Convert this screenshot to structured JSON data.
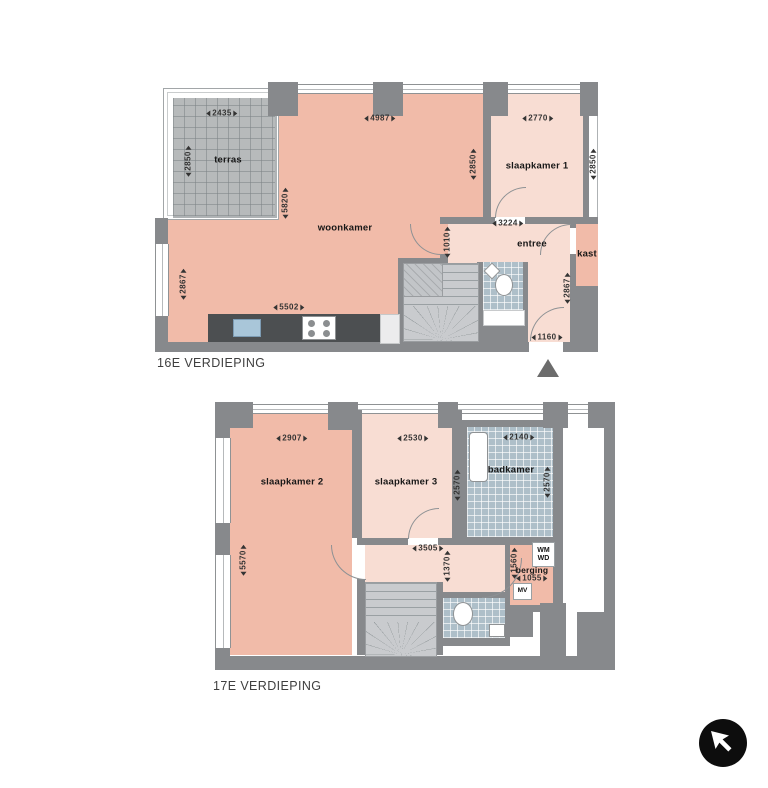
{
  "colors": {
    "room_salmon": "#f1bba9",
    "room_pink": "#f8ddd3",
    "wall_gray": "#87898c",
    "terrace_tile": "#b7babb",
    "bath_tile": "#aebfc9",
    "stair_gray": "#c9cbce",
    "counter_dark": "#4c4f51",
    "sink_blue": "#a9c6d9",
    "entrance_marker_gray": "#6c6c6c",
    "logo_black": "#0d0d0d"
  },
  "floors": [
    {
      "label": "16E VERDIEPING",
      "rooms": {
        "terras": "terras",
        "woonkamer": "woonkamer",
        "slaapkamer1": "slaapkamer 1",
        "entree": "entree",
        "kast": "kast"
      },
      "dims": {
        "terras_w": "2435",
        "terras_h": "2850",
        "woonkamer_w": "4987",
        "woonkamer_glass_h": "5820",
        "woonkamer_left_h": "2867",
        "kitchen_w": "5502",
        "slaapkamer1_w": "2770",
        "slaapkamer1_left_h": "2850",
        "slaapkamer1_right_h": "2850",
        "entree_w": "3224",
        "entree_left_h": "1010",
        "entree_right_h": "2867",
        "entry_w": "1160"
      }
    },
    {
      "label": "17E VERDIEPING",
      "rooms": {
        "slaapkamer2": "slaapkamer 2",
        "slaapkamer3": "slaapkamer 3",
        "badkamer": "badkamer",
        "berging": "berging"
      },
      "appliances": {
        "wm": "WM",
        "wd": "WD",
        "mv": "MV"
      },
      "dims": {
        "slaapkamer2_w": "2907",
        "slaapkamer2_h": "5570",
        "slaapkamer3_w": "2530",
        "slaapkamer3_h": "2570",
        "badkamer_w": "2140",
        "badkamer_h": "2570",
        "hal_w": "3505",
        "hal_h": "1370",
        "berging_h": "1560",
        "berging_w": "1055"
      }
    }
  ],
  "icons": {
    "entrance_marker": "triangle-up",
    "logo": "arrow-up-left-circle"
  }
}
